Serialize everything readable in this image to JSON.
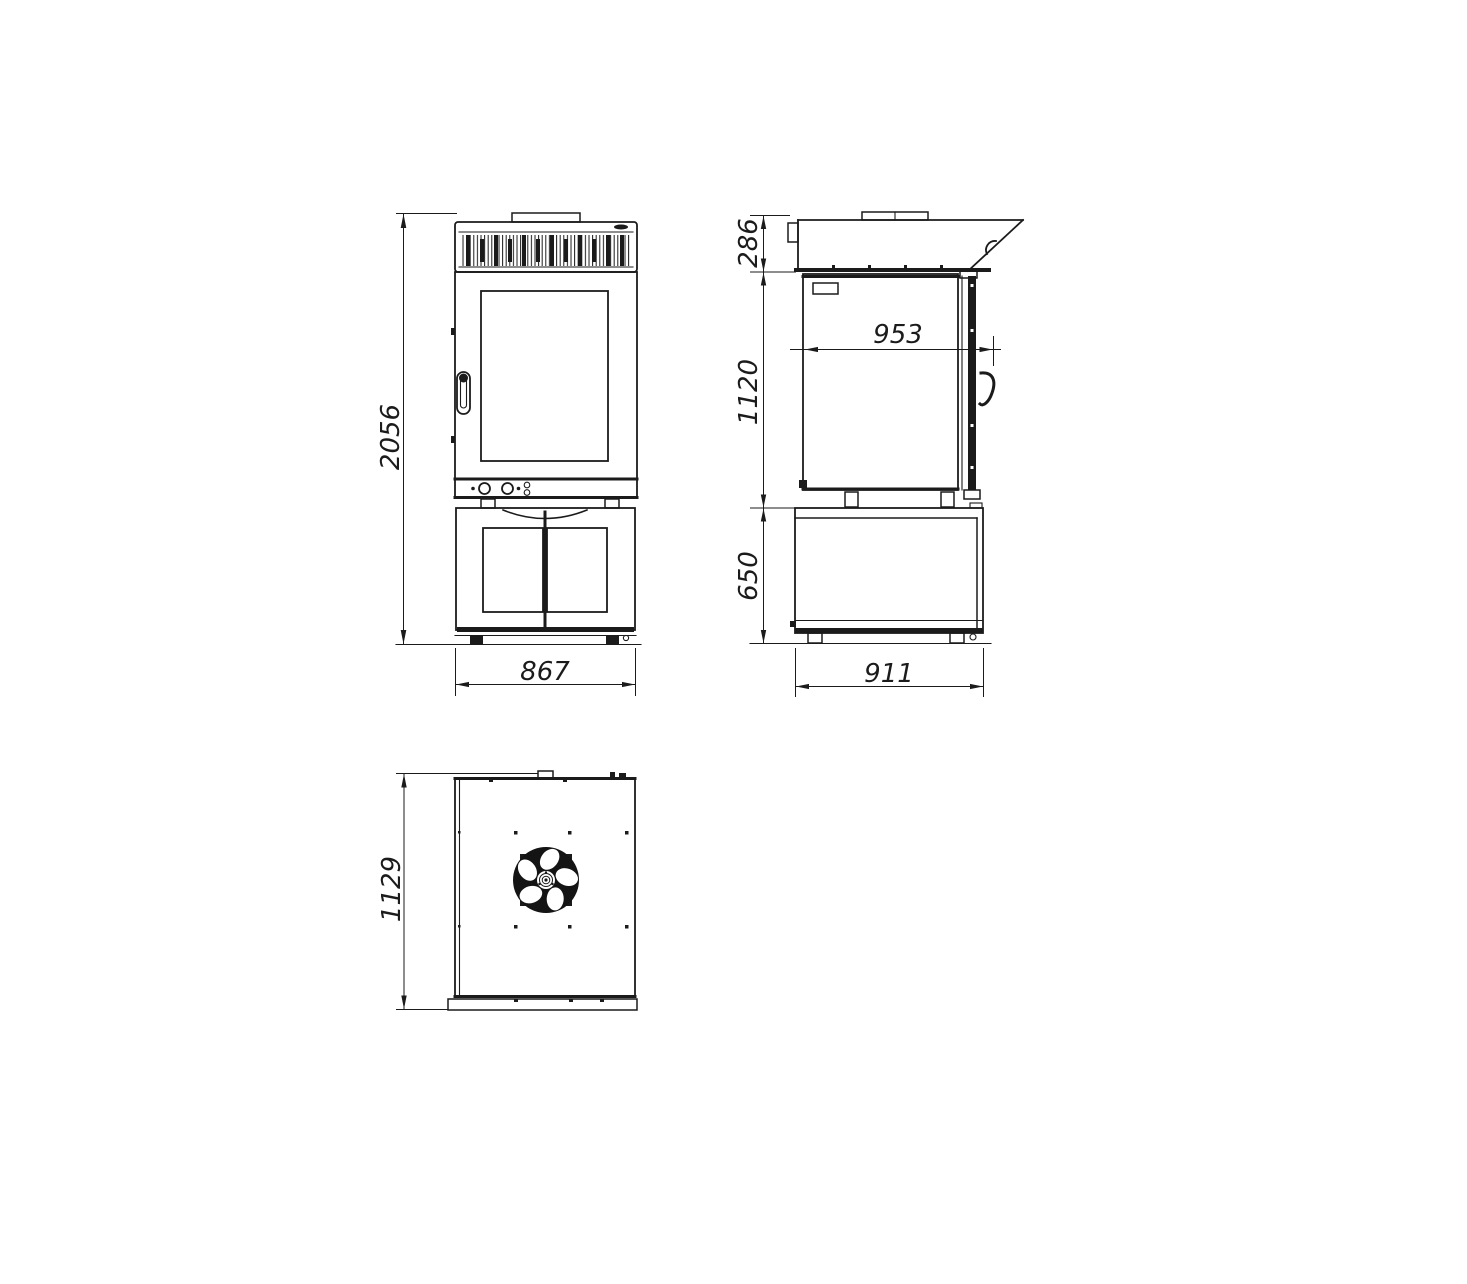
{
  "drawing": {
    "background_color": "#ffffff",
    "line_color": "#1b1b1b",
    "dimensions": {
      "front_height": "2056",
      "front_width": "867",
      "hood_height": "286",
      "body_height": "1120",
      "stand_height": "650",
      "depth_with_handle": "953",
      "stand_depth": "911",
      "top_view_depth": "1129"
    }
  }
}
